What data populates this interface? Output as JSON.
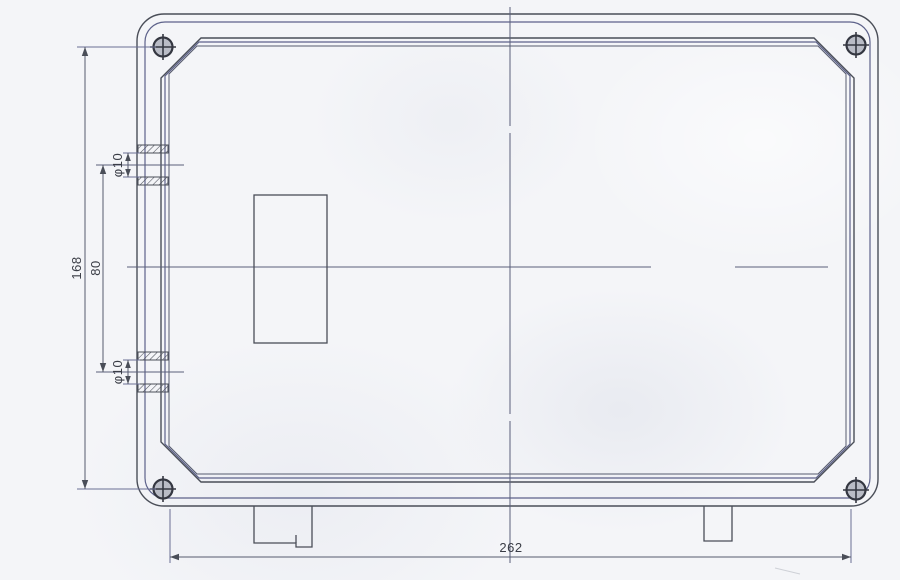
{
  "drawing": {
    "labels": {
      "overall_height": "168",
      "port_spacing": "80",
      "port_diameter_top": "φ10",
      "port_diameter_bottom": "φ10",
      "mounting_width": "262"
    },
    "colors": {
      "line": "#4a4e58",
      "line_blue": "#5d628a",
      "extension_line": "#6a6f94",
      "text": "#3a3d46",
      "background": "#f4f5f8"
    }
  }
}
